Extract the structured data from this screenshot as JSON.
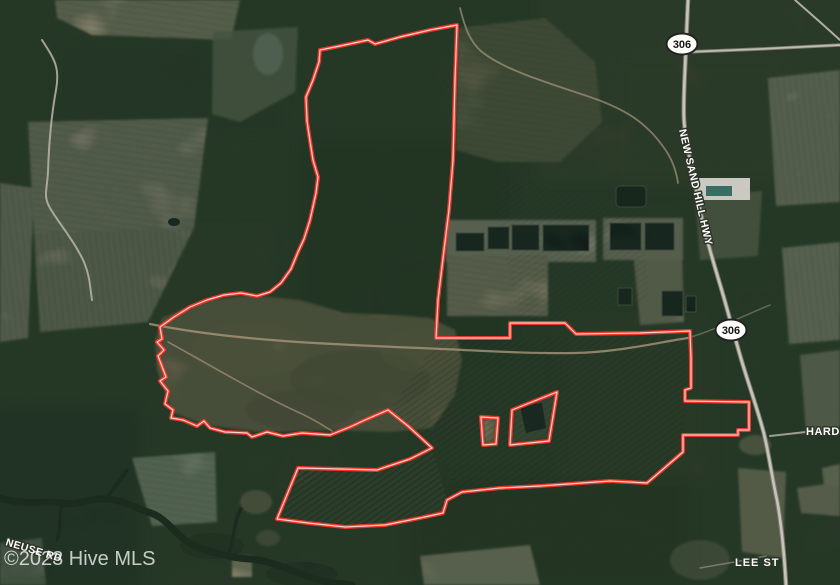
{
  "map": {
    "view": "satellite",
    "watermark": "©2023 Hive MLS",
    "boundary": {
      "color": "#f5372b",
      "kind": "parcel-outline"
    },
    "route_shields": [
      {
        "id": "route-306-north",
        "number": "306"
      },
      {
        "id": "route-306-south",
        "number": "306"
      }
    ],
    "road_labels": {
      "highway": "NEW SAND HILL HWY",
      "hardison": "HARDIS",
      "lee": "LEE ST",
      "neuse": "NEUSE RD"
    }
  }
}
